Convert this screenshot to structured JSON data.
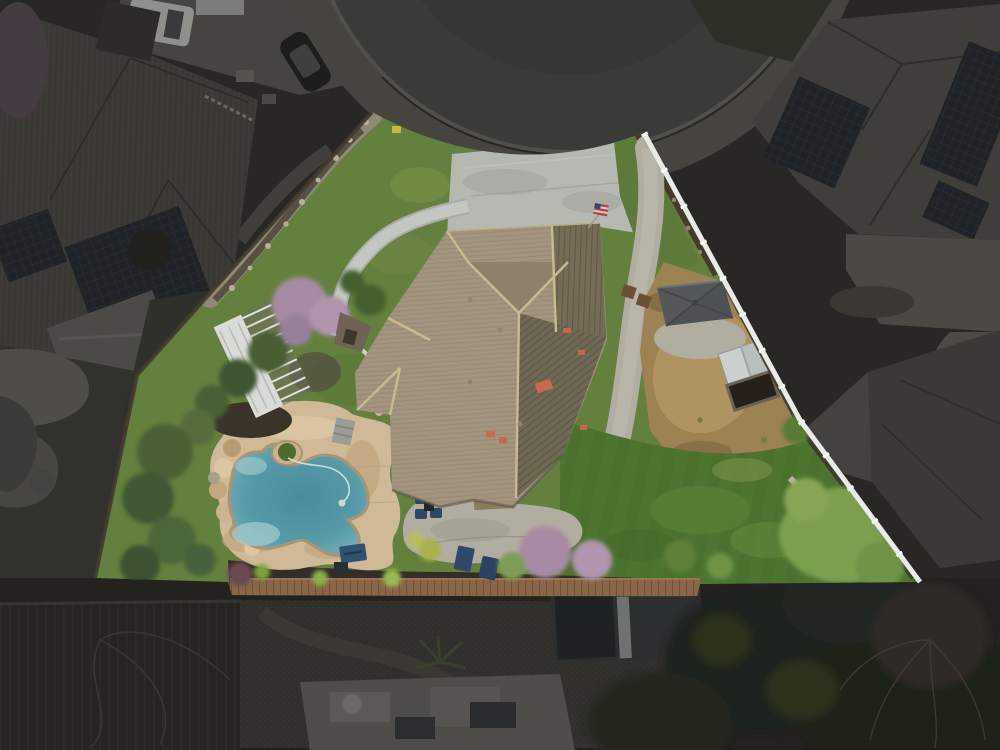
{
  "scene": {
    "type": "aerial-drone-photograph",
    "subject": "single-family residential lot highlighted against a dimmed neighborhood",
    "time_of_day": "overcast daylight",
    "highlight_style": "triangular property boundary kept bright; all surroundings darkened",
    "features": [
      "cul-de-sac street",
      "concrete driveway",
      "american-flag",
      "tan shingle hip roof",
      "rear concrete patio with furniture",
      "freeform swimming pool",
      "rock waterfall",
      "tan pool deck",
      "white pergola",
      "gray gazebo",
      "white garden shed",
      "raised garden bed",
      "bare dirt yard",
      "rear lawn",
      "front lawn",
      "white vinyl fence",
      "wood deck walkway",
      "neighbor houses with solar panels",
      "parked vehicles",
      "mature trees",
      "flowering purple trees"
    ]
  },
  "colors": {
    "background_dim": "#282725",
    "asphalt": "#3a3a37",
    "asphalt_inner": "#363633",
    "sidewalk_dim": "#45443e",
    "concrete_dim": "#4a4944",
    "dim_roof": "#3a3835",
    "dim_roof_right": "#403e3a",
    "dim_roof_br": "#3b3935",
    "solar_panel": "#1f2226",
    "dim_grass": "#31322b",
    "gravel_dim": "#302f2b",
    "shed_dim": "#2c2e30",
    "tree_dark": "#1f231b",
    "grass_front": "#64803e",
    "grass_back": "#4e7530",
    "grass_light": "#7a9448",
    "dirt": "#9d8253",
    "dirt_light": "#b69a66",
    "driveway": "#b6b8b2",
    "patio_concrete": "#b2ada1",
    "walkway": "#c3c7c1",
    "roof_light": "#a3947f",
    "roof_mid": "#8d8169",
    "roof_dark": "#746c57",
    "roof_dark2": "#6f6854",
    "ridge_cap": "#c9ba92",
    "pool_deck": "#d0b996",
    "deck_stain": "#c0a67f",
    "water_deep": "#4a8c9d",
    "water_mid": "#5699a7",
    "water_edge": "#85bac0",
    "rock_tan": "#cdb490",
    "tree_green": "#45602f",
    "juniper_bright": "#7c9f50",
    "shrub_bright": "#86a654",
    "blossom_pink": "#a78aa3",
    "fence_white": "#e9ebe6",
    "fence_dark": "#42392e",
    "wood_deck": "#8a6548",
    "gazebo_roof": "#54585a",
    "shed_white": "#cbcfce",
    "garden_bed": "#262019",
    "mulch": "#453b2b",
    "tile_orange": "#c4674f",
    "flag_red": "#b5413c",
    "flag_blue": "#3a4470",
    "furniture_blue": "#2e4764",
    "pergola_white": "#d8dbd7",
    "yellow_item": "#c9b83a"
  }
}
